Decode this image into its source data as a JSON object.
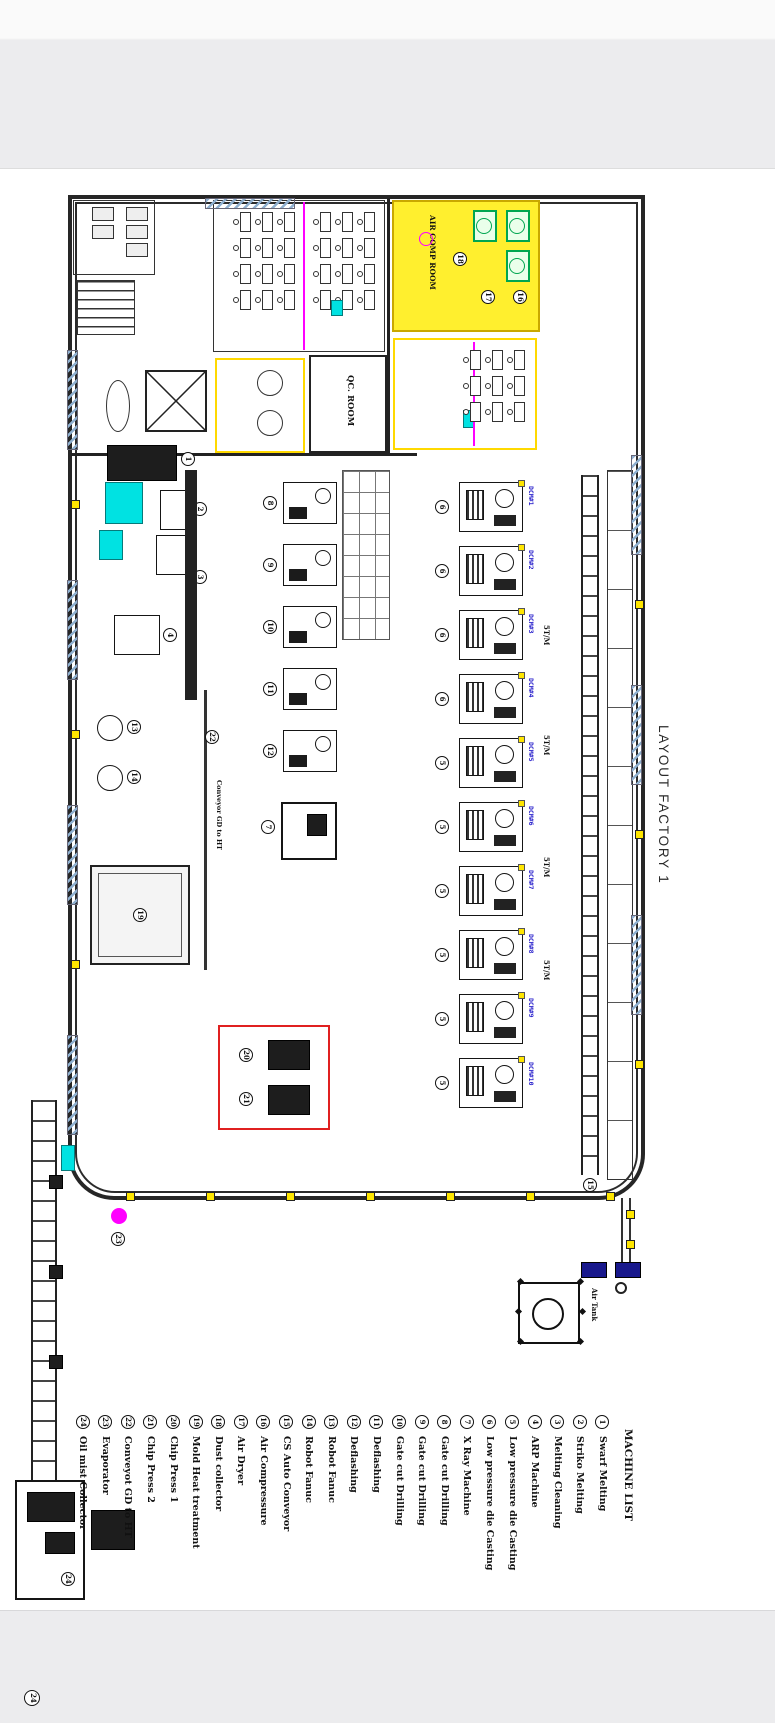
{
  "title": "LAYOUT FACTORY 1",
  "machine_list": {
    "header": "MACHINE LIST",
    "items": [
      {
        "num": "1",
        "label": "Swarf Melting"
      },
      {
        "num": "2",
        "label": "Striko Melting"
      },
      {
        "num": "3",
        "label": "Melting Cleaning"
      },
      {
        "num": "4",
        "label": "ARP Machine"
      },
      {
        "num": "5",
        "label": "Low pressure die Casting"
      },
      {
        "num": "6",
        "label": "Low pressure die Casting"
      },
      {
        "num": "7",
        "label": "X Ray Machine"
      },
      {
        "num": "8",
        "label": "Gate cut Drilling"
      },
      {
        "num": "9",
        "label": "Gate cut Drilling"
      },
      {
        "num": "10",
        "label": "Gate cut Drilling"
      },
      {
        "num": "11",
        "label": "Deflashing"
      },
      {
        "num": "12",
        "label": "Deflashing"
      },
      {
        "num": "13",
        "label": "Robot Fanuc"
      },
      {
        "num": "14",
        "label": "Robot Fanuc"
      },
      {
        "num": "15",
        "label": "CS Auto Conveyor"
      },
      {
        "num": "16",
        "label": "Air Compressure"
      },
      {
        "num": "17",
        "label": "Air Dryer"
      },
      {
        "num": "18",
        "label": "Dust collector"
      },
      {
        "num": "19",
        "label": "Mold Heat treatment"
      },
      {
        "num": "20",
        "label": "Chip Press 1"
      },
      {
        "num": "21",
        "label": "Chip Press 2"
      },
      {
        "num": "22",
        "label": "Conveyot GD to HT"
      },
      {
        "num": "23",
        "label": "Evaporator"
      },
      {
        "num": "24",
        "label": "Oil mist Collector"
      }
    ]
  },
  "rooms": {
    "qc": "QC. ROOM",
    "air_comp": "AIR COMP ROOM",
    "air_tank": "Air Tank"
  },
  "floor": {
    "dcm_machines": [
      {
        "tag": "DCM#1",
        "num": "6"
      },
      {
        "tag": "DCM#2",
        "num": "6"
      },
      {
        "tag": "DCM#3",
        "num": "6"
      },
      {
        "tag": "DCM#4",
        "num": "6"
      },
      {
        "tag": "DCM#5",
        "num": "5"
      },
      {
        "tag": "DCM#6",
        "num": "5"
      },
      {
        "tag": "DCM#7",
        "num": "5"
      },
      {
        "tag": "DCM#8",
        "num": "5"
      },
      {
        "tag": "DCM#9",
        "num": "5"
      },
      {
        "tag": "DCM#10",
        "num": "5"
      }
    ],
    "cell_machines": [
      {
        "num": "8"
      },
      {
        "num": "9"
      },
      {
        "num": "10"
      },
      {
        "num": "11"
      },
      {
        "num": "12"
      }
    ],
    "melting_nums": [
      "1",
      "2",
      "3",
      "4"
    ],
    "xray_num": "7",
    "robot_nums": [
      "13",
      "14"
    ],
    "conveyor_num": "15",
    "aircomp_nums": [
      "16",
      "17",
      "18"
    ],
    "mht_num": "19",
    "press_nums": [
      "20",
      "21"
    ],
    "gdht_num": "22",
    "evap_num": "23",
    "oil_num": "24",
    "rate_labels": [
      "5T/M",
      "5T/M",
      "5T/M",
      "5T/M"
    ],
    "gdht_note": "Conveyor GD to HT"
  },
  "colors": {
    "yellow": "#ffe600",
    "cyan": "#00e2e2",
    "magenta": "#ff00ff",
    "green": "#00a650",
    "navy": "#18188c",
    "red": "#e02020",
    "blue_text": "#2a22cc"
  }
}
